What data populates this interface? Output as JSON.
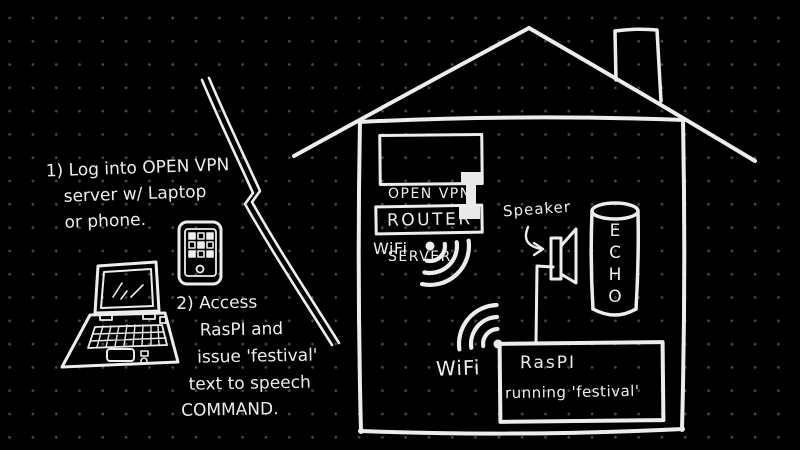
{
  "colors": {
    "background": "#000000",
    "grid_dots": "#474747",
    "chalk_stroke": "#ededed"
  },
  "annotations": {
    "step1": {
      "lines": [
        "1) Log into OPEN VPN",
        "server w/ Laptop",
        "or phone."
      ]
    },
    "step2": {
      "lines": [
        "2) Access",
        "RasPI and",
        "issue 'festival'",
        "text to speech",
        "COMMAND."
      ]
    }
  },
  "house": {
    "server_box": {
      "lines": [
        "OPEN VPN",
        "SERVER"
      ]
    },
    "router_label": "ROUTER",
    "wifi_upper_label": "WiFi",
    "speaker_label": "Speaker",
    "echo_letters": [
      "E",
      "C",
      "H",
      "O"
    ],
    "wifi_lower_label": "WiFi",
    "raspi_box": {
      "lines": [
        "RasPI",
        "running 'festival'"
      ]
    }
  },
  "icons": {
    "laptop": "laptop-icon",
    "phone": "smartphone-icon",
    "bolt": "internet-link-bolt-icon",
    "house": "house-outline-icon",
    "chimney": "chimney-icon",
    "connector": "server-router-connector-icon",
    "wifi_upper": "wifi-waves-icon",
    "wifi_lower": "wifi-waves-icon",
    "speaker": "speaker-icon",
    "speaker_arrow": "arrow-icon",
    "echo": "echo-cylinder-icon"
  }
}
